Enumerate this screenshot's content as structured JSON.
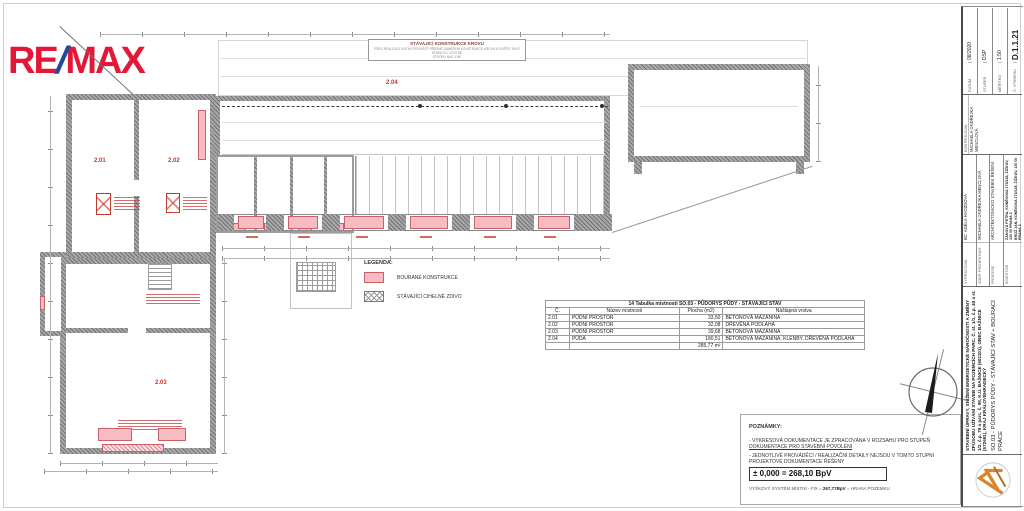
{
  "logo": {
    "re": "RE",
    "slash": "/",
    "max": "MAX"
  },
  "colors": {
    "remax_red": "#E31837",
    "remax_blue": "#1E4BA0",
    "demolition_pink": "#F6BCC1",
    "annotation_red": "#C0392B",
    "firm_logo_orange": "#D8862B"
  },
  "plan": {
    "krov_box": {
      "title": "STÁVAJÍCÍ KONSTRUKCE KROVU",
      "line1": "PŘED REALIZACÍ NUTNO PROVÉST PŘESNÉ ZAMĚŘENÍ KONSTRUKCE KROVU A OVĚŘIT JEHO STABILITU, VČETNĚ",
      "line2": "STROPU NAD 1.NP"
    },
    "rooms": [
      {
        "id": "2.01"
      },
      {
        "id": "2.02"
      },
      {
        "id": "2.03"
      },
      {
        "id": "2.04"
      }
    ]
  },
  "legend": {
    "title": "LEGENDA:",
    "items": [
      {
        "label": "BOURANÉ KONSTRUKCE",
        "swatch": "pink"
      },
      {
        "label": "STÁVAJÍCÍ CIHELNÉ ZDIVO",
        "swatch": "hatch"
      }
    ]
  },
  "room_table": {
    "title": "14 Tabulka místností SO.03 - PŮDORYS PŮDY - STÁVAJÍCÍ STAV",
    "headers": [
      "Č.",
      "Název místnosti",
      "Plocha (m2)",
      "Nášlapná vrstva"
    ],
    "rows": [
      {
        "no": "2.01",
        "name": "PŮDNÍ PROSTOR",
        "area": "33,50",
        "layer": "BETONOVÁ MAZANINA"
      },
      {
        "no": "2.02",
        "name": "PŮDNÍ PROSTOR",
        "area": "32,08",
        "layer": "DŘEVĚNÁ PODLAHA"
      },
      {
        "no": "2.03",
        "name": "PŮDNÍ PROSTOR",
        "area": "39,68",
        "layer": "BETONOVÁ MAZANINA"
      },
      {
        "no": "2.04",
        "name": "PŮDA",
        "area": "180,51",
        "layer": "BETONOVÁ MAZANINA, KLENBY, DŘEVĚNÁ PODLAHA"
      }
    ],
    "total": "285,77 m²"
  },
  "notes": {
    "title": "POZNÁMKY:",
    "note1_prefix": "- VÝKRESOVÁ DOKUMENTACE JE ZPRACOVÁNA V ROZSAHU PRO STUPEŇ ",
    "note1_underlined": "DOKUMENTACE PRO STAVEBNÍ POVOLENÍ",
    "note2": "- JEDNOTLIVÉ PROVÁDĚCÍ / REALIZAČNÍ DETAILY NEJSOU V TOMTO STUPNI PROJEKTOVÉ DOKUMENTACE ŘEŠENY"
  },
  "elevation": {
    "datum_line": "± 0,000 = 268,10 BpV",
    "system_prefix": "VÝŠKOVÝ SYSTÉM MÍSTNÍ - FIX = ",
    "system_bold": "267,77BpV",
    "system_suffix": " = HRANA POZEMKU"
  },
  "title_block": {
    "project_title": "STAVEBNÍ ÚPRAVY, SNÍŽENÍ ENERGETICKÉ NÁROČNOSTI A ZMĚNY ZPŮSOBU UŽÍVÁNÍ STAVEB NA POZEMCÍCH PARC. Č. st. 1/1, č.p. 40 a st. 1/2, č.p. 78 a parc. č. 98, K.Ú. BAŠNICE (601101), OBEC BAŠNICE (572691), KRAJ KRÁLOVÉHRADECKÝ",
    "drawing_title": "SO.03 - PŮDORYS PŮDY - STÁVAJÍCÍ STAV + BOURACÍ PRÁCE",
    "fields": {
      "vypracoval_label": "VYPRACOVAL",
      "vypracoval": "BC. ADÉLA HVOZDOVÁ",
      "zodp_projektant_label": "ZODP. PROJEKTANT",
      "zodp_projektant": "MICHAELA ONDŘEJKA MENCLOVÁ",
      "profese_label": "PROFESE",
      "profese": "ARCHITEKTONICKO STAVEBNÍ ŘEŠENÍ",
      "investor_label": "INVESTOR",
      "investor_line1": "ŽÁKOVÁ PETRA, KONĚVOVA 173/128, ŽIŽKOV, 130 00 PRAHA 3",
      "investor_line2": "BROŽ JAN, KONĚVOVA 173/128, ŽIŽKOV, 130 00 PRAHA 3",
      "kontroloval_label": "KONTROLOVAL",
      "kontroloval": "MICHAELA ONDŘEJKA MENCLOVÁ",
      "datum_label": "DATUM",
      "datum": "08/2020",
      "stupen_label": "STUPEŇ",
      "stupen": "DSP",
      "meritko_label": "MĚŘÍTKO",
      "meritko": "1:50",
      "cislo_vykresu_label": "Č. VÝKRESU",
      "cislo_vykresu": "D.1.1.21"
    }
  }
}
